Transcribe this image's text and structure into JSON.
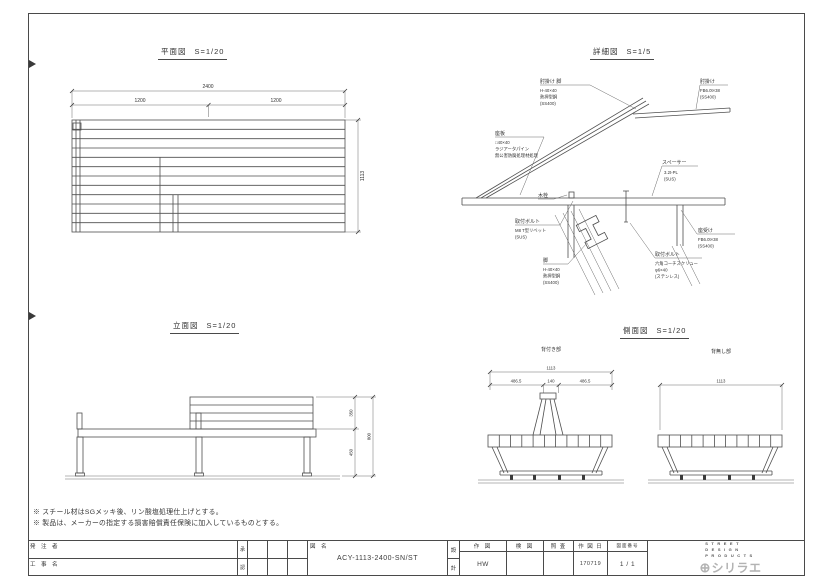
{
  "views": {
    "plan": {
      "title": "平面図",
      "scale": "S=1/20",
      "dims": {
        "total": "2400",
        "left": "1200",
        "right": "1200",
        "depth": "1113"
      }
    },
    "detail": {
      "title": "詳細図",
      "scale": "S=1/5",
      "labels": {
        "armrest_leg": {
          "title": "肘掛け 脚",
          "line1": "H-40×40",
          "line2": "熱押型鋼",
          "line3": "(SS400)"
        },
        "armrest": {
          "title": "肘掛け",
          "line1": "FB6.0t×38",
          "line2": "(SS400)"
        },
        "seat_board": {
          "title": "座板",
          "line1": "□40×40",
          "line2": "ラジアータパイン",
          "line3": "無公害防腐処理材処理"
        },
        "spacer": {
          "title": "スペーサー",
          "line1": "3.2t-PL",
          "line2": "(SUS)"
        },
        "wood_plug": {
          "title": "木栓"
        },
        "mount_bolt_left": {
          "title": "取付ボルト",
          "line1": "M8 T型リベット",
          "line2": "(SUS)"
        },
        "seat_support": {
          "title": "座受け",
          "line1": "FB6.0t×38",
          "line2": "(SS400)"
        },
        "leg": {
          "title": "脚",
          "line1": "H-40×40",
          "line2": "熱押型鋼",
          "line3": "(SS400)"
        },
        "mount_bolt_right": {
          "title": "取付ボルト",
          "line1": "六角コーチスクリュー",
          "line2": "φ6×40",
          "line3": "(ステンレス)"
        }
      }
    },
    "elevation": {
      "title": "立面図",
      "scale": "S=1/20",
      "dims": {
        "back_height": "350",
        "seat_height": "450",
        "total_height": "800"
      }
    },
    "side": {
      "title": "側面図",
      "scale": "S=1/20",
      "left_section": {
        "title": "背付き部",
        "dims": {
          "total": "1113",
          "a": "486.5",
          "b": "140",
          "c": "486.5"
        }
      },
      "right_section": {
        "title": "背無し部",
        "dims": {
          "total": "1113"
        }
      }
    }
  },
  "notes": [
    "※ スチール材はSGメッキ後、リン酸塩処理仕上げとする。",
    "※ 製品は、メーカーの指定する損害賠償責任保険に加入しているものとする。"
  ],
  "title_block": {
    "orderer_label": "発 注 者",
    "project_label": "工 事 名",
    "approval_top": "承",
    "approval_bottom": "認",
    "drawing_name_label": "図 名",
    "drawing_name": "ACY-1113-2400-SN/ST",
    "design_top": "設",
    "design_bottom": "計",
    "drafting_label": "作 図",
    "drafting_value": "HW",
    "check_label": "検 図",
    "review_label": "照 査",
    "date_label": "作 図 日",
    "date_value": "170719",
    "sheet_no_label": "図面番号",
    "sheet_no_value": "1 / 1",
    "brand_line1": "STREET",
    "brand_line2": "DESIGN",
    "brand_line3": "PRODUCTS",
    "logo_mark": "⊕",
    "logo_text": "シリラエ"
  }
}
